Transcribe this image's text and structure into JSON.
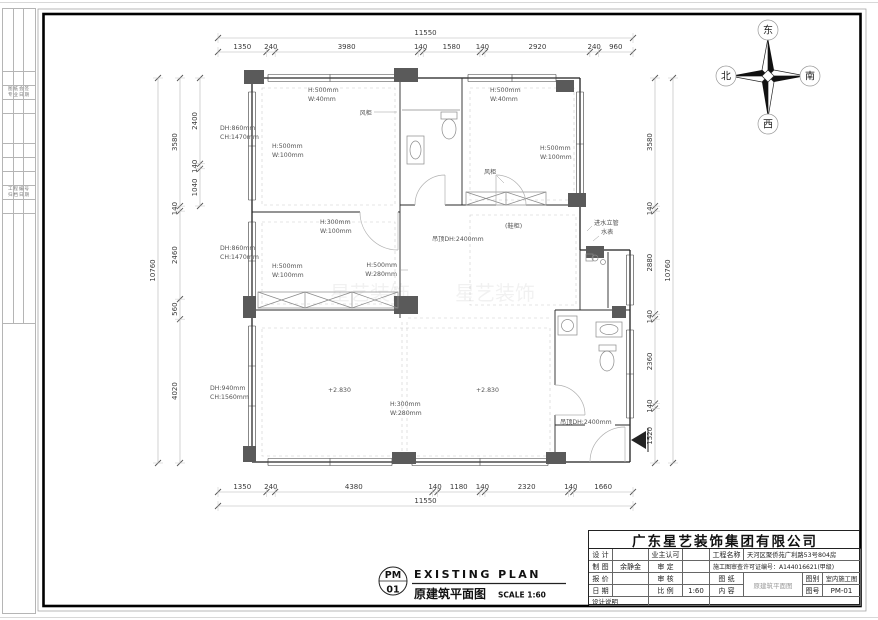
{
  "sheet": {
    "plan_title_en": "EXISTING PLAN",
    "plan_title_cn": "原建筑平面图",
    "plan_scale": "SCALE 1:60",
    "sheet_no_top": "PM",
    "sheet_no_bottom": "01",
    "watermark": "星艺装饰"
  },
  "compass": {
    "top": "东",
    "left": "北",
    "right": "南",
    "bottom": "西"
  },
  "dimensions": {
    "top": {
      "total": "11550",
      "segments": [
        "1350",
        "240",
        "3980",
        "140",
        "1580",
        "140",
        "2920",
        "240",
        "960"
      ]
    },
    "bottom": {
      "total": "11550",
      "segments": [
        "1350",
        "240",
        "4380",
        "140",
        "1180",
        "140",
        "2320",
        "140",
        "1660"
      ]
    },
    "left": {
      "total": "10760",
      "segments": [
        "3580",
        "140",
        "2460",
        "560",
        "4020"
      ],
      "inner_segments": [
        "2400",
        "140",
        "1040"
      ]
    },
    "right": {
      "total": "10760",
      "segments": [
        "3580",
        "140",
        "2880",
        "140",
        "2360",
        "140",
        "1520"
      ]
    }
  },
  "plan_labels": {
    "win_a_top_1": "H:500mm",
    "win_a_top_2": "W:40mm",
    "win_a_left_1": "H:500mm",
    "win_a_left_2": "W:100mm",
    "win_a_out_1": "DH:860mm",
    "win_a_out_2": "CH:1470mm",
    "win_d_out_1": "DH:860mm",
    "win_d_out_2": "CH:1470mm",
    "win_d_left_1": "H:500mm",
    "win_d_left_2": "W:100mm",
    "flue_1": "风柜",
    "win_c_top_1": "H:500mm",
    "win_c_top_2": "W:40mm",
    "win_c_right_1": "H:500mm",
    "win_c_right_2": "W:100mm",
    "flue_2": "风柜",
    "win_d_top_1": "H:300mm",
    "win_d_top_2": "W:100mm",
    "ceiling_hall": "吊顶DH:2400mm",
    "win_d_right_1": "H:500mm",
    "win_d_right_2": "W:280mm",
    "shoe_cabinet": "(鞋柜)",
    "riser": "进水立管",
    "meter": "水表",
    "win_f_out_1": "DH:940mm",
    "win_f_out_2": "CH:1560mm",
    "level_1": "+2.830",
    "level_2": "+2.830",
    "win_f_mid_1": "H:300mm",
    "win_f_mid_2": "W:280mm",
    "ceiling_entry": "吊顶DH:2400mm"
  },
  "titleblock": {
    "company": "广东星艺装饰集团有限公司",
    "design_label": "设 计",
    "owner_label": "业主认可",
    "draft_label": "制 图",
    "draft_value": "余静金",
    "approve_label": "审 定",
    "quote_label": "报 价",
    "check_label": "审 核",
    "date_label": "日 期",
    "scale_label": "比 例",
    "scale_value": "1:60",
    "notes_label": "设计说明",
    "project_label": "工程名称",
    "project_value": "天河区聚侨苑广利路53号804房",
    "permit": "施工图审查许可证编号：A144016621(甲级)",
    "sheet_label": "图 纸",
    "content_label": "内 容",
    "content_value": "原建筑平面图",
    "type_label": "图别",
    "type_value": "室内施工图",
    "no_label": "图号",
    "no_value": "PM-01"
  },
  "margin_stamps": {
    "stamp_1a": "图纸会签",
    "stamp_1b": "专业日期",
    "stamp_2a": "工程编号",
    "stamp_2b": "归档日期"
  }
}
